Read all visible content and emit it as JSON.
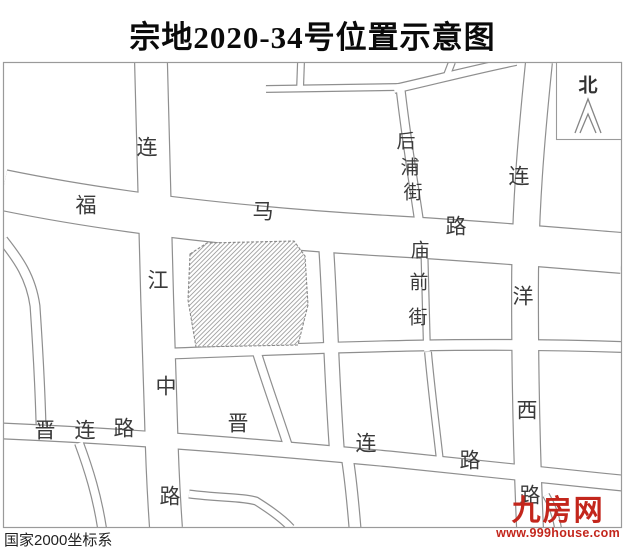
{
  "title": "宗地2020-34号位置示意图",
  "map": {
    "north_label": "北",
    "coordinate_system": "国家2000坐标系",
    "road_labels": [
      {
        "road": "连江中路",
        "chars": [
          "连",
          "江",
          "中",
          "路"
        ]
      },
      {
        "road": "福马路",
        "chars": [
          "福",
          "马",
          "路"
        ]
      },
      {
        "road": "后浦街",
        "chars": [
          "后",
          "浦",
          "街"
        ]
      },
      {
        "road": "庙前街",
        "chars": [
          "庙",
          "前",
          "街"
        ]
      },
      {
        "road": "连洋西路",
        "chars": [
          "连",
          "洋",
          "西",
          "路"
        ]
      },
      {
        "road": "晋连路",
        "chars": [
          "晋",
          "连",
          "路"
        ]
      },
      {
        "road": "晋连路",
        "chars": [
          "晋",
          "连",
          "路"
        ]
      }
    ],
    "colors": {
      "road_line": "#8f8f8f",
      "frame": "#9a9a9a",
      "label": "#3a3a3a",
      "parcel_hatch": "#a0a0a0",
      "parcel_border": "#8a8a8a"
    }
  },
  "watermark": {
    "logo_text": "九房网",
    "website": "www.999house.com",
    "color": "#c3261c"
  }
}
